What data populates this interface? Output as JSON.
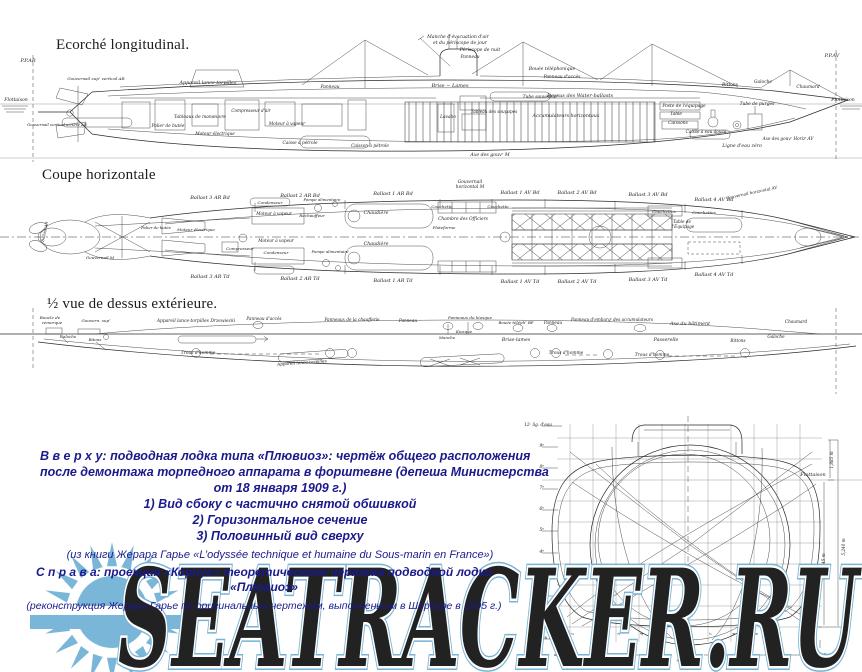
{
  "titles": {
    "longitudinal": "Ecorché longitudinal.",
    "horizontal": "Coupe horizontale",
    "top_half": "½ vue de dessus extérieure."
  },
  "caption_top": {
    "line1": "В в е р х у: подводная лодка типа «Плювиоз»: чертёж общего расположения",
    "line2": "после демонтажа торпедного аппарата в форштевне (депеша Министерства",
    "line3": "от 18 января 1909 г.)",
    "line4": "1) Вид сбоку с частично снятой обшивкой",
    "line5": "2) Горизонтальное сечение",
    "line6": "3) Половинный вид сверху",
    "source": "(из книги Жерара Гарье «L’odyssée technique et humaine du Sous-marin en France»)"
  },
  "caption_right": {
    "line1": "С п р а в а: проекция «Корпус» теоретического чертежа подводной лодки",
    "line2": "«Плювиоз»",
    "source": "(реконструкция Жерара Гарье по оригинальным чертежам, выполненным в Шербуре в 1905 г.)"
  },
  "watermark": {
    "text": "SEATRACKER.RU",
    "color": "#76b3d5",
    "sun_color": "#7ab6d8"
  },
  "long_view": {
    "labels": [
      {
        "t": "P.P.AR",
        "x": 28,
        "y": 32,
        "s": 5
      },
      {
        "t": "P.P.AV",
        "x": 832,
        "y": 27,
        "s": 5
      },
      {
        "t": "Flottaison",
        "x": 16,
        "y": 71,
        "s": 4.6
      },
      {
        "t": "Flottaison",
        "x": 843,
        "y": 71,
        "s": 4.6
      },
      {
        "t": "Manche d'évacuation d'air",
        "x": 458,
        "y": 8,
        "s": 4.6
      },
      {
        "t": "et du périscope de jour",
        "x": 460,
        "y": 14,
        "s": 4.6
      },
      {
        "t": "Périscope de nuit",
        "x": 480,
        "y": 21,
        "s": 4.6
      },
      {
        "t": "Panneau",
        "x": 470,
        "y": 28,
        "s": 4.4
      },
      {
        "t": "Bouée téléphonique",
        "x": 552,
        "y": 40,
        "s": 4.6
      },
      {
        "t": "Panneau d'accès",
        "x": 562,
        "y": 48,
        "s": 4.4
      },
      {
        "t": "Brise − Lames",
        "x": 450,
        "y": 57,
        "s": 5
      },
      {
        "t": "Dessus des Water-ballasts",
        "x": 580,
        "y": 67,
        "s": 5
      },
      {
        "t": "Appareil lance-torpilles",
        "x": 208,
        "y": 54,
        "s": 4.8
      },
      {
        "t": "Panneau",
        "x": 330,
        "y": 58,
        "s": 4.4
      },
      {
        "t": "Tube sauveteur",
        "x": 540,
        "y": 68,
        "s": 4.4
      },
      {
        "t": "Tableaux de manœuvre",
        "x": 200,
        "y": 88,
        "s": 4.4
      },
      {
        "t": "Palier de butée",
        "x": 168,
        "y": 97,
        "s": 4.3
      },
      {
        "t": "Moteur électrique",
        "x": 215,
        "y": 105,
        "s": 4.3
      },
      {
        "t": "Compresseur d'air",
        "x": 251,
        "y": 82,
        "s": 4.2
      },
      {
        "t": "Moteur à vapeur",
        "x": 287,
        "y": 95,
        "s": 4.3
      },
      {
        "t": "Caisse à pétrole",
        "x": 300,
        "y": 114,
        "s": 4.3
      },
      {
        "t": "Caisson à pétrole",
        "x": 370,
        "y": 117,
        "s": 4.3
      },
      {
        "t": "Lavabo",
        "x": 448,
        "y": 88,
        "s": 4.3
      },
      {
        "t": "Tableau des soupapes",
        "x": 494,
        "y": 83,
        "s": 4.2
      },
      {
        "t": "Accumulateurs horizontaux",
        "x": 566,
        "y": 87,
        "s": 4.8
      },
      {
        "t": "Poste de l'équipage",
        "x": 684,
        "y": 77,
        "s": 4.4
      },
      {
        "t": "Table",
        "x": 676,
        "y": 85,
        "s": 4.4
      },
      {
        "t": "Caissons",
        "x": 678,
        "y": 94,
        "s": 4.4
      },
      {
        "t": "Caisse à eau douce",
        "x": 706,
        "y": 103,
        "s": 4.2
      },
      {
        "t": "Tube de purges",
        "x": 757,
        "y": 75,
        "s": 4.4
      },
      {
        "t": "Axe des gouvʳ Horizᵗ AV",
        "x": 788,
        "y": 110,
        "s": 4.2
      },
      {
        "t": "Ligne d'eau zéro",
        "x": 742,
        "y": 117,
        "s": 4.7
      },
      {
        "t": "Axe des gouvʳ M",
        "x": 490,
        "y": 126,
        "s": 4.7
      },
      {
        "t": "Bittons",
        "x": 730,
        "y": 56,
        "s": 4.4
      },
      {
        "t": "Galoche",
        "x": 763,
        "y": 53,
        "s": 4.4
      },
      {
        "t": "Chaumard",
        "x": 808,
        "y": 58,
        "s": 4.4
      },
      {
        "t": "Gouvernail supʳ vertical AR",
        "x": 96,
        "y": 50,
        "s": 4.1
      },
      {
        "t": "Gouvernail vertical arrière AR",
        "x": 57,
        "y": 96,
        "s": 3.9
      }
    ]
  },
  "plan_view": {
    "ballast_top": [
      {
        "t": "Ballast 3 AR Bd",
        "x": 210,
        "y": 21
      },
      {
        "t": "Ballast 2 AR Bd",
        "x": 300,
        "y": 19
      },
      {
        "t": "Ballast 1 AR Bd",
        "x": 393,
        "y": 17
      },
      {
        "t": "Ballast 1 AV Bd",
        "x": 520,
        "y": 16
      },
      {
        "t": "Ballast 2 AV Bd",
        "x": 577,
        "y": 16
      },
      {
        "t": "Ballast 3 AV Bd",
        "x": 648,
        "y": 18
      },
      {
        "t": "Ballast 4 AV Bd",
        "x": 714,
        "y": 23
      }
    ],
    "ballast_bottom": [
      {
        "t": "Ballast 3 AR Td",
        "x": 210,
        "y": 100
      },
      {
        "t": "Ballast 2 AR Td",
        "x": 300,
        "y": 102
      },
      {
        "t": "Ballast 1 AR Td",
        "x": 393,
        "y": 104
      },
      {
        "t": "Ballast 1 AV Td",
        "x": 520,
        "y": 105
      },
      {
        "t": "Ballast 2 AV Td",
        "x": 577,
        "y": 105
      },
      {
        "t": "Ballast 3 AV Td",
        "x": 648,
        "y": 103
      },
      {
        "t": "Ballast 4 AV Td",
        "x": 714,
        "y": 98
      }
    ],
    "labels": [
      {
        "t": "Gouvernail",
        "x": 470,
        "y": 5,
        "s": 4.4
      },
      {
        "t": "horizontal M",
        "x": 470,
        "y": 10,
        "s": 4.4
      },
      {
        "t": "Gouvernail horizontal AV",
        "x": 752,
        "y": 16,
        "s": 4.1,
        "r": -12
      },
      {
        "t": "Chambre des Officiers",
        "x": 463,
        "y": 42,
        "s": 4.4
      },
      {
        "t": "Couchette",
        "x": 442,
        "y": 30,
        "s": 4.1
      },
      {
        "t": "Couchette",
        "x": 498,
        "y": 30,
        "s": 4.1
      },
      {
        "t": "Couchettes",
        "x": 664,
        "y": 35,
        "s": 4.1
      },
      {
        "t": "Couchettes",
        "x": 704,
        "y": 36,
        "s": 4.1
      },
      {
        "t": "Table de",
        "x": 682,
        "y": 45,
        "s": 4.2
      },
      {
        "t": "l'Équipage",
        "x": 683,
        "y": 50,
        "s": 4.2
      },
      {
        "t": "Plateforme",
        "x": 444,
        "y": 51,
        "s": 4.1
      },
      {
        "t": "Moteur électrique",
        "x": 196,
        "y": 53,
        "s": 4.1
      },
      {
        "t": "Moteur à vapeur",
        "x": 274,
        "y": 37,
        "s": 4.2
      },
      {
        "t": "Moteur à vapeur",
        "x": 276,
        "y": 64,
        "s": 4.2
      },
      {
        "t": "Condenseur",
        "x": 270,
        "y": 26,
        "s": 4.1
      },
      {
        "t": "Condenseur",
        "x": 276,
        "y": 76,
        "s": 4.1
      },
      {
        "t": "Compresseur",
        "x": 240,
        "y": 72,
        "s": 4.1
      },
      {
        "t": "Réchauffeur",
        "x": 312,
        "y": 39,
        "s": 4.1
      },
      {
        "t": "Chaudière",
        "x": 376,
        "y": 36,
        "s": 4.7
      },
      {
        "t": "Chaudière",
        "x": 376,
        "y": 67,
        "s": 4.7
      },
      {
        "t": "Pompe alimentaire",
        "x": 322,
        "y": 23,
        "s": 3.9
      },
      {
        "t": "Pompe alimentaire",
        "x": 330,
        "y": 75,
        "s": 3.9
      },
      {
        "t": "Palier de butée",
        "x": 156,
        "y": 51,
        "s": 3.9
      },
      {
        "t": "Gouvernail M",
        "x": 100,
        "y": 81,
        "s": 4.1
      },
      {
        "t": "Ballast AR",
        "x": 46,
        "y": 54,
        "s": 3.9,
        "r": -78
      }
    ]
  },
  "top_view": {
    "labels": [
      {
        "t": "Boucle de",
        "x": 50,
        "y": 11,
        "s": 4.1
      },
      {
        "t": "remorque",
        "x": 52,
        "y": 16,
        "s": 4.1
      },
      {
        "t": "Gouvern. supʳ",
        "x": 96,
        "y": 14,
        "s": 4.1
      },
      {
        "t": "Galoche",
        "x": 68,
        "y": 30,
        "s": 4
      },
      {
        "t": "Bitons",
        "x": 95,
        "y": 33,
        "s": 4
      },
      {
        "t": "Appareil lance-torpilles  Drzewiecki",
        "x": 196,
        "y": 14,
        "s": 4.4
      },
      {
        "t": "Panneau d'accès",
        "x": 264,
        "y": 12,
        "s": 4.2
      },
      {
        "t": "Panneaux de la chaufferie",
        "x": 352,
        "y": 13,
        "s": 4.2
      },
      {
        "t": "Panneau",
        "x": 408,
        "y": 14,
        "s": 4.2
      },
      {
        "t": "Panneaux du kiosque",
        "x": 470,
        "y": 11,
        "s": 4.1
      },
      {
        "t": "Bouée téléphʳ BF",
        "x": 516,
        "y": 16,
        "s": 4
      },
      {
        "t": "Panneau",
        "x": 553,
        "y": 16,
        "s": 4.2
      },
      {
        "t": "Panneau d'embarqᵗ des accumulateurs",
        "x": 612,
        "y": 13,
        "s": 4.2
      },
      {
        "t": "Axe du bâtiment",
        "x": 690,
        "y": 17,
        "s": 4.8
      },
      {
        "t": "Chaumard",
        "x": 796,
        "y": 15,
        "s": 4.2
      },
      {
        "t": "Manche",
        "x": 447,
        "y": 31,
        "s": 4
      },
      {
        "t": "Kiosque",
        "x": 464,
        "y": 25,
        "s": 4
      },
      {
        "t": "Brise-lames",
        "x": 516,
        "y": 33,
        "s": 4.8
      },
      {
        "t": "Passerelle",
        "x": 666,
        "y": 33,
        "s": 4.8
      },
      {
        "t": "Bittons",
        "x": 738,
        "y": 34,
        "s": 4.2
      },
      {
        "t": "Galoche",
        "x": 776,
        "y": 30,
        "s": 4.2
      },
      {
        "t": "Trous d'homme",
        "x": 198,
        "y": 46,
        "s": 4.4
      },
      {
        "t": "Trous d'homme",
        "x": 566,
        "y": 46,
        "s": 4.4
      },
      {
        "t": "Trous d'homme",
        "x": 652,
        "y": 48,
        "s": 4.4
      },
      {
        "t": "Appareil lance-torpilles",
        "x": 302,
        "y": 56,
        "s": 4.2,
        "r": -4
      }
    ]
  },
  "body_plan": {
    "labels": [
      {
        "t": "Flottaison",
        "x": 301,
        "y": 64,
        "s": 5
      },
      {
        "t": "4,970 m",
        "x": 176,
        "y": 250,
        "s": 5.5
      },
      {
        "t": "1,885 m",
        "x": 321,
        "y": 48,
        "s": 4.2,
        "r": -90
      },
      {
        "t": "4,645 m",
        "x": 313,
        "y": 150,
        "s": 4.2,
        "r": -90
      },
      {
        "t": "5,240 m",
        "x": 333,
        "y": 135,
        "s": 4.2,
        "r": -90
      }
    ],
    "scale_left": [
      {
        "t": "12ᵉ lig. d'eau",
        "x": 40,
        "y": 14,
        "s": 4.2,
        "a": "end"
      },
      {
        "t": "9ᵉ",
        "x": 32,
        "y": 35,
        "s": 4.4,
        "a": "end"
      },
      {
        "t": "8ᵉ",
        "x": 32,
        "y": 56,
        "s": 4.4,
        "a": "end"
      },
      {
        "t": "7ᵉ",
        "x": 32,
        "y": 77,
        "s": 4.4,
        "a": "end"
      },
      {
        "t": "6ᵉ",
        "x": 32,
        "y": 98,
        "s": 4.4,
        "a": "end"
      },
      {
        "t": "5ᵉ",
        "x": 32,
        "y": 119,
        "s": 4.4,
        "a": "end"
      },
      {
        "t": "4ᵉ",
        "x": 32,
        "y": 141,
        "s": 4.4,
        "a": "end"
      },
      {
        "t": "3ᵉ",
        "x": 32,
        "y": 162,
        "s": 4.4,
        "a": "end"
      },
      {
        "t": "2ᵉ",
        "x": 32,
        "y": 184,
        "s": 4.4,
        "a": "end"
      },
      {
        "t": "1ʳᵉ",
        "x": 32,
        "y": 205,
        "s": 4.4,
        "a": "end"
      },
      {
        "t": "Lig. d'eau 0ᵐ",
        "x": 42,
        "y": 227,
        "s": 4.2,
        "a": "end"
      }
    ],
    "sections_bottom": [
      {
        "t": "1",
        "x": 62,
        "y": 222,
        "s": 4,
        "r": -90
      },
      {
        "t": "2",
        "x": 85,
        "y": 222,
        "s": 4,
        "r": -90
      },
      {
        "t": "3",
        "x": 108,
        "y": 222,
        "s": 4,
        "r": -90
      },
      {
        "t": "4",
        "x": 131,
        "y": 222,
        "s": 4,
        "r": -90
      },
      {
        "t": "5",
        "x": 154,
        "y": 222,
        "s": 4,
        "r": -90
      },
      {
        "t": "6",
        "x": 177,
        "y": 222,
        "s": 4,
        "r": -90
      },
      {
        "t": "7",
        "x": 200,
        "y": 222,
        "s": 4,
        "r": -90
      },
      {
        "t": "8",
        "x": 223,
        "y": 222,
        "s": 4,
        "r": -90
      },
      {
        "t": "9",
        "x": 246,
        "y": 222,
        "s": 4,
        "r": -90
      },
      {
        "t": "10",
        "x": 269,
        "y": 222,
        "s": 4,
        "r": -90
      }
    ]
  }
}
